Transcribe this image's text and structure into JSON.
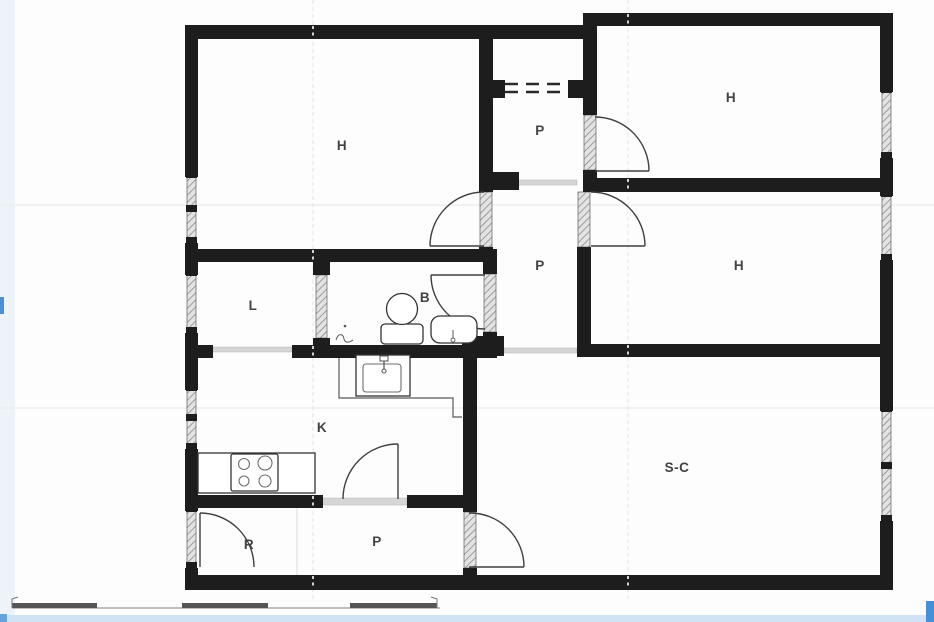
{
  "plan": {
    "rooms": [
      {
        "id": "h-top-left",
        "label": "H"
      },
      {
        "id": "p-top",
        "label": "P"
      },
      {
        "id": "h-top-right",
        "label": "H"
      },
      {
        "id": "h-mid-right",
        "label": "H"
      },
      {
        "id": "p-corridor",
        "label": "P"
      },
      {
        "id": "l-room",
        "label": "L"
      },
      {
        "id": "b-bathroom",
        "label": "B"
      },
      {
        "id": "k-kitchen",
        "label": "K"
      },
      {
        "id": "r-room",
        "label": "R"
      },
      {
        "id": "p-bottom",
        "label": "P"
      },
      {
        "id": "sc-living",
        "label": "S-C"
      }
    ],
    "fixtures": [
      "toilet",
      "bathtub",
      "floor-drain",
      "kitchen-sink",
      "stove-cooktop"
    ],
    "features": [
      "windows-hatched",
      "door-swings",
      "overhead-beam-dashed",
      "section-lines",
      "scale-bar"
    ],
    "colors": {
      "wall": "#1d1d1d",
      "room_label": "#424242",
      "door_arc": "#3f3f3f",
      "threshold": "#d6d6d6",
      "window_hatch": "#8a8a8a",
      "accent_blue": "#4590d7",
      "strip_blue": "#cfe3f5",
      "left_margin_tint": "#eef3f9"
    }
  }
}
